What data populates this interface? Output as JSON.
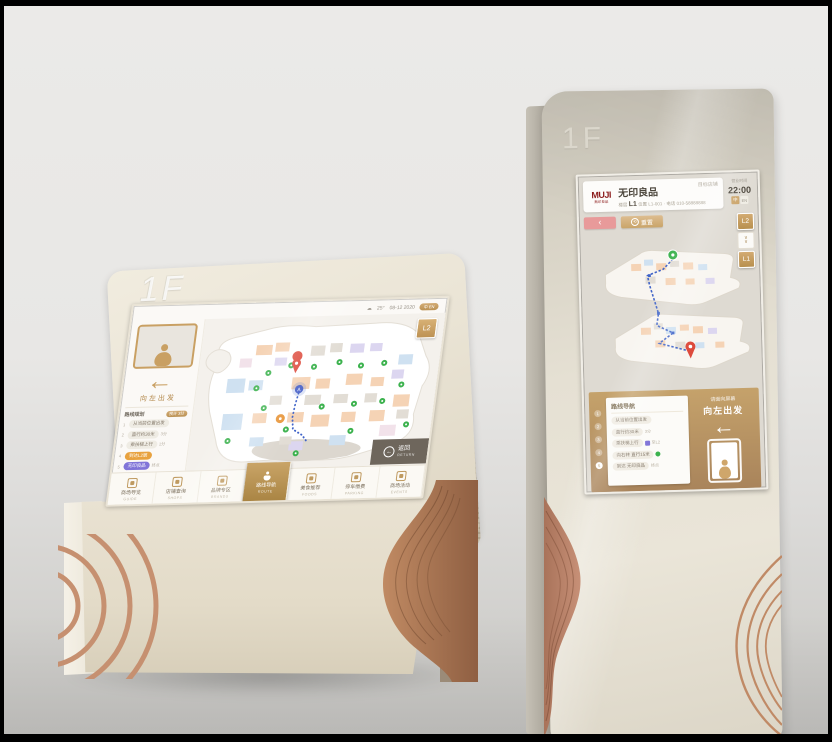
{
  "colors": {
    "gold_accent": "#bf9a60",
    "copper_decor": "#c08a66",
    "kiosk_cream": "#e9e3d6",
    "dark_button": "#6e665c",
    "muji_red": "#8c1c1c",
    "route_blue": "#3f63c8",
    "marker_green": "#3cb24e",
    "pin_red": "#dd4a3c"
  },
  "left_kiosk": {
    "floor_label": "1F",
    "screen": {
      "status": {
        "weather": "25°",
        "date": "08-12 2020",
        "lang": "中 EN"
      },
      "floor_button": "L2",
      "sidebar": {
        "direction_text": "向左出发",
        "plan_title": "路线规划",
        "plan_badge": "预计 3分",
        "steps": [
          {
            "num": "1",
            "text": "从当前位置出发",
            "meta": ""
          },
          {
            "num": "2",
            "text": "直行约30米",
            "meta": "3分"
          },
          {
            "num": "3",
            "text": "乘扶梯上行",
            "meta": "1分"
          },
          {
            "num": "4",
            "text": "到达L2层",
            "meta": ""
          },
          {
            "num": "5",
            "text": "无印良品",
            "meta": "终点"
          }
        ]
      },
      "return_button": {
        "zh": "返回",
        "en": "RETURN"
      },
      "nav_tabs": [
        {
          "zh": "商场导览",
          "en": "GUIDE"
        },
        {
          "zh": "店铺查询",
          "en": "SHOPS"
        },
        {
          "zh": "品牌专区",
          "en": "BRANDS"
        },
        {
          "zh": "路线导航",
          "en": "ROUTE"
        },
        {
          "zh": "美食推荐",
          "en": "FOODS"
        },
        {
          "zh": "停车缴费",
          "en": "PARKING"
        },
        {
          "zh": "商场活动",
          "en": "EVENTS"
        }
      ]
    }
  },
  "right_kiosk": {
    "floor_label": "1F",
    "screen": {
      "header": {
        "logo": "MUJI",
        "logo_sub": "無印良品",
        "store_name": "无印良品",
        "floor_label": "楼层",
        "floor_value": "L1",
        "meta": "位置 L1-001 · 电话 010-58888888",
        "target_label": "目标店铺",
        "hours_label": "营业时间",
        "closing_time": "22:00",
        "lang_cn": "中",
        "lang_en": "EN"
      },
      "toolbar": {
        "back": "‹",
        "reset": "重置"
      },
      "floor_switcher": {
        "top": "L2",
        "bottom": "L1"
      },
      "route_panel": {
        "title": "路线导航",
        "steps": [
          {
            "num": "1",
            "text": "从当前位置出发",
            "meta": ""
          },
          {
            "num": "2",
            "text": "直行约30米",
            "meta": "3分"
          },
          {
            "num": "3",
            "text": "乘扶梯上行",
            "meta": "至L2"
          },
          {
            "num": "4",
            "text": "向右转 直行15米",
            "meta": ""
          },
          {
            "num": "5",
            "text": "到达 无印良品",
            "meta": "终点"
          }
        ]
      },
      "direction_panel": {
        "hint": "请面向屏幕",
        "action": "向左出发"
      }
    }
  }
}
